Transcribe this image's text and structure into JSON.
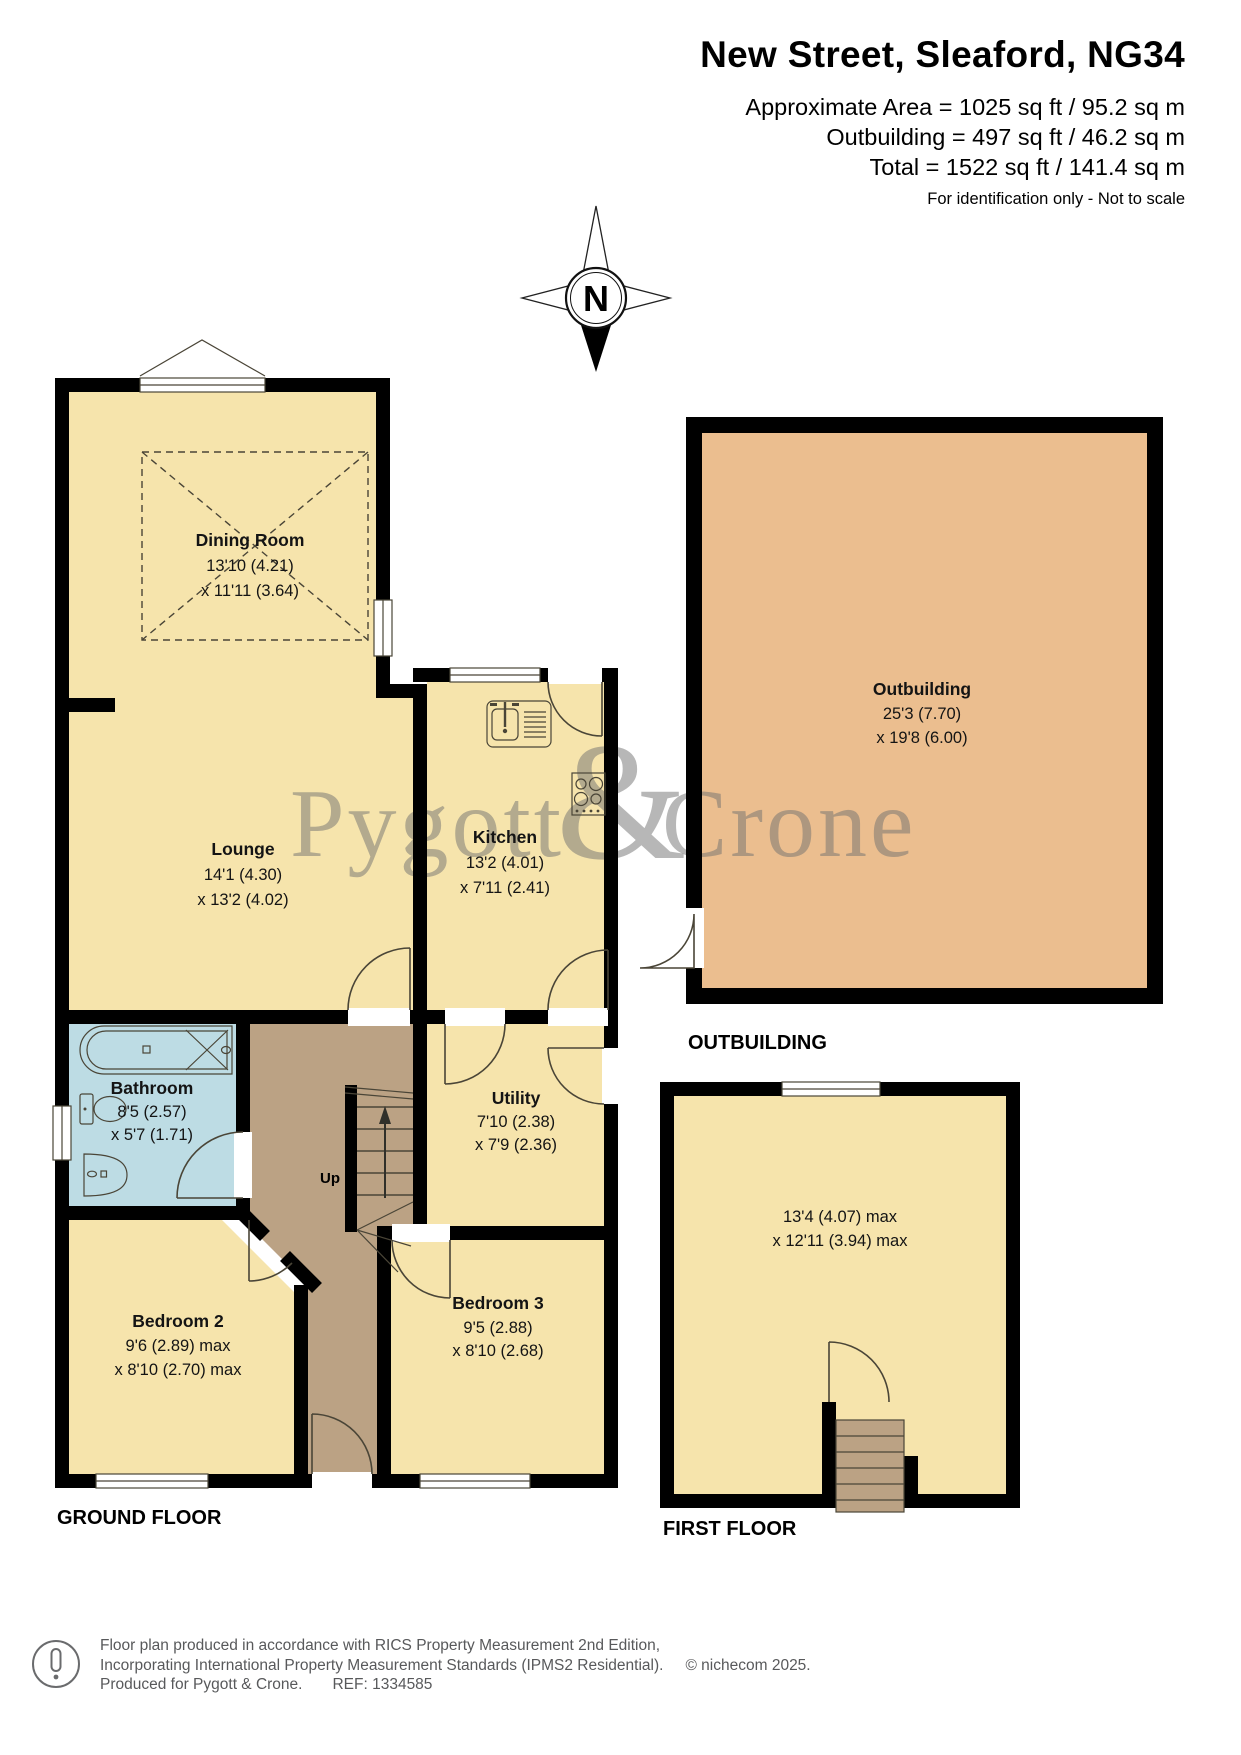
{
  "header": {
    "title": "New Street, Sleaford, NG34",
    "area_line1": "Approximate Area = 1025 sq ft / 95.2 sq m",
    "area_line2": "Outbuilding = 497 sq ft / 46.2 sq m",
    "area_line3": "Total = 1522 sq ft / 141.4 sq m",
    "note": "For identification only - Not to scale"
  },
  "compass": {
    "letter": "N"
  },
  "watermark": {
    "word1": "Pygott",
    "amp": "&",
    "word2": "Crone"
  },
  "ground_floor": {
    "caption": "GROUND FLOOR",
    "stairs_label": "Up",
    "rooms": {
      "dining": {
        "name": "Dining Room",
        "dim1": "13'10 (4.21)",
        "dim2": "x 11'11 (3.64)"
      },
      "lounge": {
        "name": "Lounge",
        "dim1": "14'1 (4.30)",
        "dim2": "x 13'2 (4.02)"
      },
      "kitchen": {
        "name": "Kitchen",
        "dim1": "13'2 (4.01)",
        "dim2": "x 7'11 (2.41)"
      },
      "bathroom": {
        "name": "Bathroom",
        "dim1": "8'5 (2.57)",
        "dim2": "x 5'7 (1.71)"
      },
      "utility": {
        "name": "Utility",
        "dim1": "7'10 (2.38)",
        "dim2": "x 7'9 (2.36)"
      },
      "bedroom2": {
        "name": "Bedroom 2",
        "dim1": "9'6 (2.89) max",
        "dim2": "x 8'10 (2.70) max"
      },
      "bedroom3": {
        "name": "Bedroom 3",
        "dim1": "9'5 (2.88)",
        "dim2": "x 8'10 (2.68)"
      }
    }
  },
  "outbuilding": {
    "caption": "OUTBUILDING",
    "room": {
      "name": "Outbuilding",
      "dim1": "25'3 (7.70)",
      "dim2": "x 19'8 (6.00)"
    }
  },
  "first_floor": {
    "caption": "FIRST FLOOR",
    "room": {
      "dim1": "13'4 (4.07) max",
      "dim2": "x 12'11 (3.94) max"
    }
  },
  "footer": {
    "line1": "Floor plan produced in accordance with RICS Property Measurement 2nd Edition,",
    "line2": "Incorporating International Property Measurement Standards (IPMS2 Residential).",
    "copyright": "© nichecom 2025.",
    "line3a": "Produced for Pygott & Crone.",
    "line3b": "REF: 1334585"
  },
  "colors": {
    "room_yellow": "#F6E4AC",
    "hall_brown": "#BBA284",
    "bathroom_blue": "#BDDCE4",
    "outbuilding_peach": "#EBBE8F",
    "wall_black": "#000000",
    "line_dark": "#4A4537",
    "watermark_gray": "#6F6F6F"
  }
}
